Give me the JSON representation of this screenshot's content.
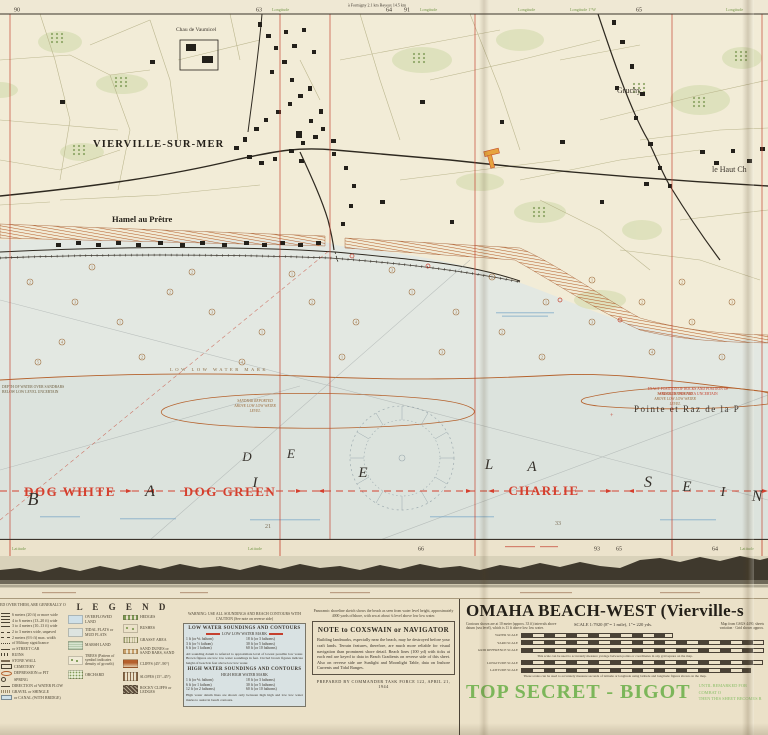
{
  "map": {
    "margin_top": {
      "n90": "90",
      "n63": "63",
      "lon1": "Longitude",
      "route_note": "à Formigny 2.1 km      Bayeux 14.5 km",
      "n64": "64",
      "n91": "91",
      "lon2": "Longitude",
      "lon3": "Longitude",
      "lon4": "Longitude 1°W",
      "n65": "65",
      "lon5": "Longitude"
    },
    "margin_bottom": {
      "lat1": "Latitude",
      "lat2": "Latitude",
      "n66": "66",
      "n93": "93",
      "n65": "65",
      "n64": "64",
      "lat3": "Latitude"
    },
    "places": {
      "village": "VIERVILLE-SUR-MER",
      "hamlet": "Hamel au Prêtre",
      "chateau": "Chau de Vaumicel",
      "gruchy": "Gruchy",
      "lehaut": "le Haut Ch",
      "pointe": "Pointe et Raz de la P"
    },
    "water_labels": {
      "llw_mark": "LOW LOW WATER MARK",
      "sandbar_l1": "SANDBAR REPORTED",
      "sandbar_l2": "ABOVE LOW LOW WATER",
      "sandbar_l3": "LEVEL",
      "depth_l1": "DEPTH OF WATER OVER SANDBARS",
      "depth_l2": "BELOW LOW LEVEL UNCERTAIN",
      "rocks_l1": "EXACT POSITION OF ROCKS AND POSITION OF",
      "rocks_l2": "WRECK IN THIS AREA UNCERTAIN"
    },
    "bay_name": "BAIE DE LA SEINE",
    "bay_letters": [
      {
        "ch": "B",
        "x": 33,
        "y": 505,
        "s": 18
      },
      {
        "ch": "A",
        "x": 150,
        "y": 496,
        "s": 16
      },
      {
        "ch": "I",
        "x": 255,
        "y": 487,
        "s": 15
      },
      {
        "ch": "E",
        "x": 363,
        "y": 477,
        "s": 15
      },
      {
        "ch": "D",
        "x": 247,
        "y": 461,
        "s": 13
      },
      {
        "ch": "E",
        "x": 291,
        "y": 458,
        "s": 13
      },
      {
        "ch": "L",
        "x": 489,
        "y": 469,
        "s": 15
      },
      {
        "ch": "A",
        "x": 532,
        "y": 471,
        "s": 15
      },
      {
        "ch": "S",
        "x": 648,
        "y": 487,
        "s": 16
      },
      {
        "ch": "E",
        "x": 687,
        "y": 491,
        "s": 15
      },
      {
        "ch": "I",
        "x": 723,
        "y": 496,
        "s": 14
      },
      {
        "ch": "N",
        "x": 757,
        "y": 501,
        "s": 16
      }
    ],
    "sectors": [
      {
        "label": "DOG WHITE",
        "x": 70,
        "y": 496
      },
      {
        "label": "DOG GREEN",
        "x": 230,
        "y": 496
      },
      {
        "label": "CHARLIE",
        "x": 544,
        "y": 495
      }
    ],
    "soundings": [
      {
        "x": 30,
        "y": 282,
        "v": "2"
      },
      {
        "x": 75,
        "y": 302,
        "v": "3"
      },
      {
        "x": 120,
        "y": 322,
        "v": "1"
      },
      {
        "x": 62,
        "y": 342,
        "v": "4"
      },
      {
        "x": 170,
        "y": 292,
        "v": "2"
      },
      {
        "x": 212,
        "y": 312,
        "v": "3"
      },
      {
        "x": 262,
        "y": 332,
        "v": "1"
      },
      {
        "x": 312,
        "y": 302,
        "v": "2"
      },
      {
        "x": 356,
        "y": 322,
        "v": "4"
      },
      {
        "x": 412,
        "y": 292,
        "v": "1"
      },
      {
        "x": 456,
        "y": 312,
        "v": "3"
      },
      {
        "x": 502,
        "y": 332,
        "v": "2"
      },
      {
        "x": 546,
        "y": 302,
        "v": "1"
      },
      {
        "x": 592,
        "y": 322,
        "v": "3"
      },
      {
        "x": 642,
        "y": 302,
        "v": "2"
      },
      {
        "x": 692,
        "y": 322,
        "v": "1"
      },
      {
        "x": 732,
        "y": 302,
        "v": "3"
      },
      {
        "x": 38,
        "y": 362,
        "v": "5"
      },
      {
        "x": 142,
        "y": 357,
        "v": "2"
      },
      {
        "x": 242,
        "y": 362,
        "v": "4"
      },
      {
        "x": 342,
        "y": 357,
        "v": "1"
      },
      {
        "x": 442,
        "y": 352,
        "v": "3"
      },
      {
        "x": 542,
        "y": 357,
        "v": "2"
      },
      {
        "x": 652,
        "y": 352,
        "v": "4"
      },
      {
        "x": 722,
        "y": 357,
        "v": "1"
      },
      {
        "x": 92,
        "y": 267,
        "v": "1"
      },
      {
        "x": 192,
        "y": 272,
        "v": "2"
      },
      {
        "x": 292,
        "y": 274,
        "v": "1"
      },
      {
        "x": 392,
        "y": 270,
        "v": "3"
      },
      {
        "x": 492,
        "y": 277,
        "v": "2"
      },
      {
        "x": 592,
        "y": 280,
        "v": "1"
      },
      {
        "x": 682,
        "y": 282,
        "v": "2"
      }
    ],
    "depths": [
      {
        "x": 265,
        "y": 528,
        "v": "21"
      },
      {
        "x": 555,
        "y": 525,
        "v": "33"
      }
    ]
  },
  "legend": {
    "header": "L E G E N D",
    "header_note": "ED OVER THEM, ARE GENERALLY OPEN FIELDS",
    "roads": [
      {
        "sym": "double",
        "label": "6 meters (20 ft) or more wide"
      },
      {
        "sym": "double",
        "label": "4 to 6 meters (13–20 ft) wide"
      },
      {
        "sym": "solid",
        "label": "3 to 4 meters (10–13 ft) wide"
      },
      {
        "sym": "dashed",
        "label": "2 to 3 meters wide, unpaved"
      },
      {
        "sym": "dashed",
        "label": "2 meters (6½ ft) max. width"
      },
      {
        "sym": "dots",
        "label": "of Military significance"
      },
      {
        "sym": "rail",
        "label": "or STREET CAR"
      },
      {
        "sym": "ruins",
        "label": "RUINS"
      },
      {
        "sym": "wall",
        "label": "STONE WALL"
      },
      {
        "sym": "cem",
        "label": "CEMETERY"
      },
      {
        "sym": "dep",
        "label": "DEPRESSION or PIT"
      },
      {
        "sym": "spring",
        "label": "SPRING"
      },
      {
        "sym": "flow",
        "label": "DIRECTION of WATER FLOW"
      },
      {
        "sym": "gravel",
        "label": "GRAVEL or SHINGLE"
      },
      {
        "sym": "canal",
        "label": "or CANAL (WITH BRIDGE)"
      }
    ],
    "land": [
      {
        "sym": "blue",
        "label": "OVERFLOWED LAND"
      },
      {
        "sym": "bluegray",
        "label": "TIDAL FLATS or MUD FLATS"
      },
      {
        "sym": "marsh",
        "label": "MARSH LAND"
      },
      {
        "sym": "trees",
        "label": "TREES (Pattern of symbol indicates density of growth)"
      },
      {
        "sym": "orchard",
        "label": "ORCHARD"
      }
    ],
    "veg": [
      {
        "sym": "hedge",
        "label": "HEDGES"
      },
      {
        "sym": "bush",
        "label": "BUSHES"
      },
      {
        "sym": "grass",
        "label": "GRASSY AREA"
      },
      {
        "sym": "sand",
        "label": "SAND DUNES or SAND BARS, SAND"
      },
      {
        "sym": "cliff",
        "label": "CLIFFS (45°–90°)"
      },
      {
        "sym": "slope",
        "label": "SLOPES (15°–45°)"
      },
      {
        "sym": "rocky",
        "label": "ROCKY CLIFFS or LEDGES"
      }
    ]
  },
  "soundings_panel": {
    "warning": "WARNING: USE ALL SOUNDINGS AND BEACH CONTOURS WITH CAUTION  (See note on reverse side)",
    "low_header": "LOW WATER SOUNDINGS AND CONTOURS",
    "low_sub": "LOW LOW WATER MARK",
    "low_rows": [
      "1 ft (or ⅙ fathom)",
      "18 ft (or 3 fathoms)",
      "3 ft (or ½ fathom)",
      "30 ft (or 5 fathoms)",
      "6 ft (or 1 fathom)",
      "60 ft (or 10 fathoms)"
    ],
    "low_note": "All sounding datum is referred to approximate level of lowest possible low water. Brown figures are low low water soundings in feet. Circled brown figures indicate height of beach in feet above low low water.",
    "high_header": "HIGH WATER SOUNDINGS AND CONTOURS",
    "high_sub": "HIGH HIGH WATER MARK",
    "high_rows": [
      "1 ft (or ⅙ fathom)",
      "18 ft (or 3 fathoms)",
      "6 ft (or 1 fathom)",
      "30 ft (or 5 fathoms)",
      "12 ft (or 2 fathoms)",
      "60 ft (or 10 fathoms)"
    ],
    "high_note": "High water datum lines are shown only between high high and low low water marks to assist in beach contours."
  },
  "coxswain": {
    "caption": "Panoramic shoreline sketch shows the beach as seen from water level height, approximately 4000 yards offshore, with sea at about ¼ level above low low water.",
    "heading": "NOTE to COXSWAIN or NAVIGATOR",
    "body": "Building landmarks, especially near the beach, may be destroyed before your craft lands. Terrain features, therefore, are much more reliable for visual navigation than prominent shore detail. Beach lines (100 yd) with ticks at each end are keyed to data in Beach Gradients on reverse side of this sheet. Also on reverse side are Sunlight and Moonlight Table, data on Inshore Currents and Tidal Ranges.",
    "prepared": "PREPARED BY COMMANDER TASK FORCE 122, APRIL 21, 1944"
  },
  "titleblock": {
    "title": "OMAHA BEACH-WEST (Vierville-s",
    "contours_note": "Contours shown are at 10 meter (approx. 33 ft) intervals above datum (sea level), which is 11 ft above low low water.",
    "scale_text": "SCALE 1:7920 (8″= 1 mile), 1″= 220 yds.",
    "source_l1": "Map from GSGS 4490, sheets",
    "source_l2": "variation · Grid shown approx.",
    "bars": [
      {
        "label": "WATER SCALE"
      },
      {
        "label": "YARD SCALE"
      },
      {
        "label": "GRID REFERENCE SCALE"
      },
      {
        "label": "LONGITUDE SCALE"
      },
      {
        "label": "LATITUDE SCALE"
      }
    ],
    "grid_note": "This scale can be used to accurately measure yardage between points or coordinates in any grid square on the map.",
    "latlon_note": "These scales can be used to accurately measure seconds of latitude or longitude using latitude and longitude figures shown on the map.",
    "classification": "TOP SECRET - BIGOT",
    "class_note_l1": "UNTIL REMARKED FOR COMBAT O",
    "class_note_l2": "THEN THIS SHEET BECOMES R"
  }
}
